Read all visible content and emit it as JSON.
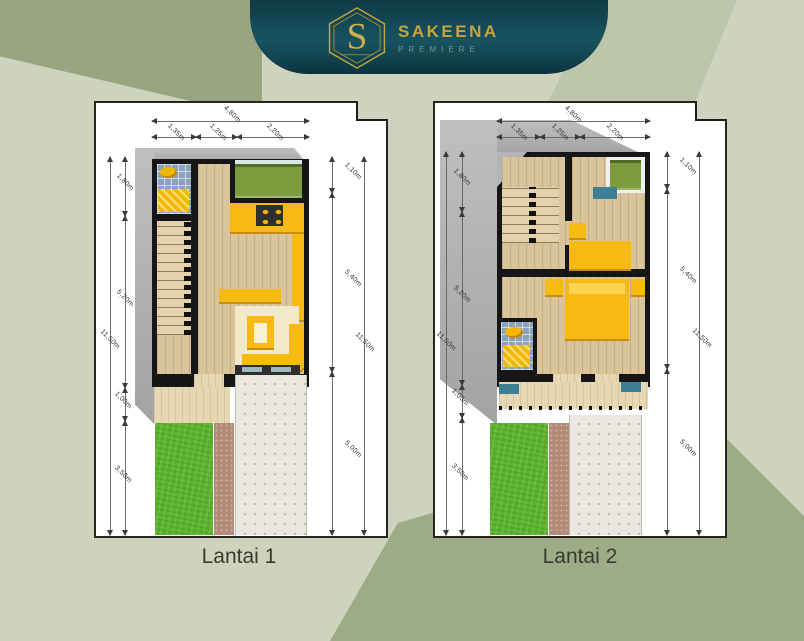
{
  "brand": {
    "logo_letter": "S",
    "name": "SAKEENA",
    "tagline": "PREMIERE"
  },
  "plans": [
    {
      "caption": "Lantai 1",
      "dims": {
        "top_total": "4,80m",
        "top_segments": [
          "1,35m",
          "1,25m",
          "2,20m"
        ],
        "left_total": "11,50m",
        "left_segments": [
          "1,80m",
          "5,20m",
          "1,00m",
          "3,50m"
        ],
        "right_segments": [
          "1,10m",
          "5,40m",
          "5,00m"
        ],
        "right_total": "11,50m"
      }
    },
    {
      "caption": "Lantai 2",
      "dims": {
        "top_total": "4,80m",
        "top_segments": [
          "1,35m",
          "1,25m",
          "2,20m"
        ],
        "left_total": "11,50m",
        "left_segments": [
          "1,80m",
          "5,20m",
          "1,00m",
          "3,50m"
        ],
        "right_segments": [
          "1,10m",
          "5,40m",
          "5,00m"
        ],
        "right_total": "11,50m"
      }
    }
  ],
  "colors": {
    "banner_teal": "#123f4c",
    "gold": "#c9a43c",
    "premiere_teal": "#6b9a90",
    "background_sage": "#cdd3bd",
    "background_dark_sage": "#9dab86",
    "wall_black": "#161616",
    "furniture_yellow": "#f6ba12",
    "grass_green": "#5cb32c",
    "bathroom_blue": "#8ba3bd",
    "wood": "#d9c49c",
    "concrete": "#e9e7e0",
    "path_mauve": "#b28a77",
    "caption_text": "#383b2e"
  }
}
